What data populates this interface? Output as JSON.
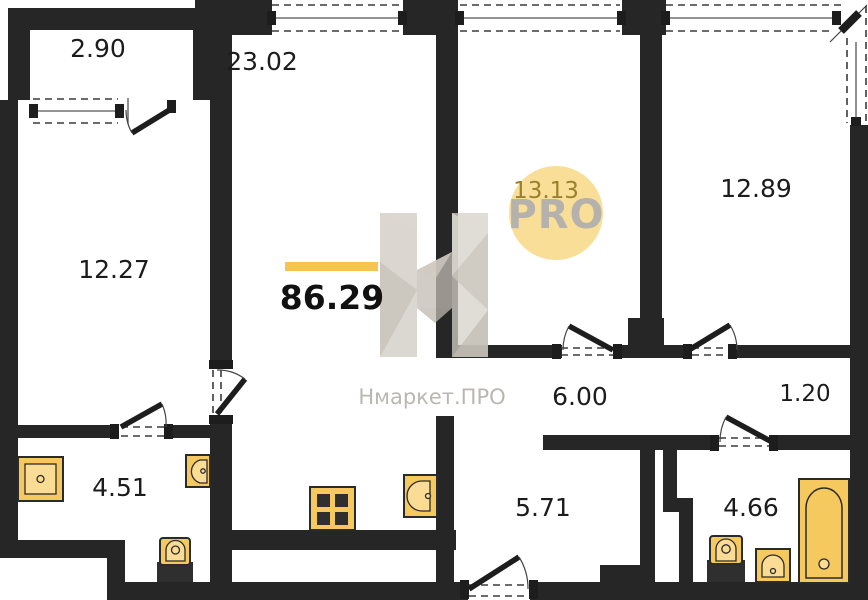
{
  "plan": {
    "total_area": "86.29",
    "rooms": [
      {
        "name": "balcony",
        "area": "2.90"
      },
      {
        "name": "living-kitchen",
        "area": "23.02"
      },
      {
        "name": "bedroom-left",
        "area": "12.27"
      },
      {
        "name": "bedroom-middle",
        "area": "13.13"
      },
      {
        "name": "bedroom-right",
        "area": "12.89"
      },
      {
        "name": "corridor",
        "area": "6.00"
      },
      {
        "name": "niche",
        "area": "1.20"
      },
      {
        "name": "bathroom-left",
        "area": "4.51"
      },
      {
        "name": "hall",
        "area": "5.71"
      },
      {
        "name": "bathroom-right",
        "area": "4.66"
      }
    ],
    "watermark": {
      "brand": "Нмаркет.ПРО",
      "logo_text": "PRO"
    },
    "fixtures": [
      "shower-tray",
      "sink",
      "toilet",
      "stove",
      "kitchen-sink",
      "toilet",
      "sink",
      "bathtub"
    ],
    "colors": {
      "accent_yellow": "#F5C451",
      "fixture_yellow": "#F6C95F",
      "fixture_light": "#FBDC94",
      "logo_circle_yellow": "#F8DB8E",
      "wall_black": "#262626",
      "watermark_grey": "#cfc9c1",
      "olive_label": "#97812e"
    }
  }
}
